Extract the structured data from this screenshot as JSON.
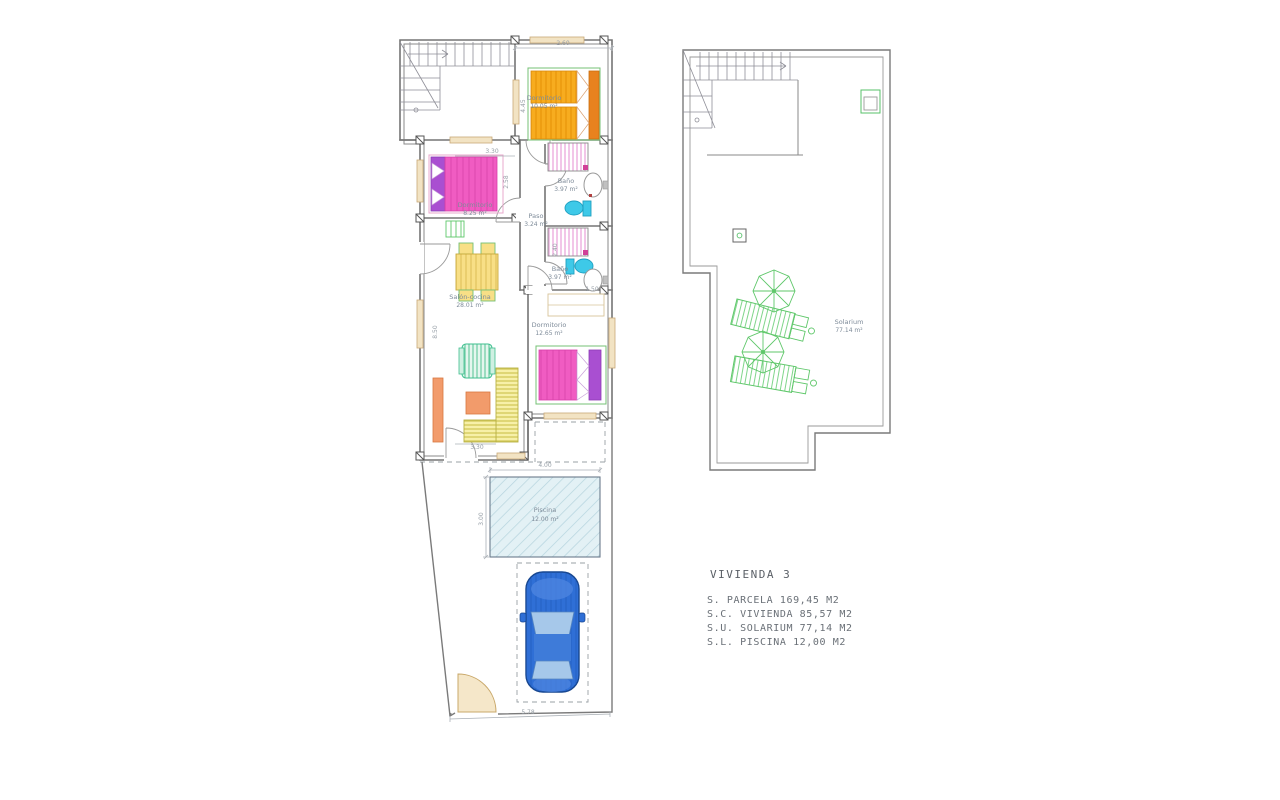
{
  "document": {
    "type": "architectural floor plan",
    "sheet_background": "#ffffff"
  },
  "ground_floor": {
    "rooms": {
      "dormitorio_top": {
        "name": "Dormitorio",
        "area": "10.05 m²"
      },
      "bano_1": {
        "name": "Baño",
        "area": "3.97 m²"
      },
      "dormitorio_mid": {
        "name": "Dormitorio",
        "area": "8.25 m²"
      },
      "paso": {
        "name": "Paso",
        "area": "3.24 m²"
      },
      "bano_2": {
        "name": "Baño",
        "area": "3.97 m²"
      },
      "salon_cocina": {
        "name": "Salón-cocina",
        "area": "28.01 m²"
      },
      "dormitorio_bottom": {
        "name": "Dormitorio",
        "area": "12.65 m²"
      },
      "piscina": {
        "name": "Piscina",
        "area": "12.00 m²"
      }
    },
    "dimensions": {
      "top_width": "2.60",
      "dorm_top_depth": "4.45",
      "dorm_mid_width": "3.30",
      "dorm_mid_depth": "2.58",
      "salon_height": "8.50",
      "bano2_depth": "2.40",
      "bano2_width": "1.50",
      "terrace_door": "3.30",
      "pool_width": "4.00",
      "pool_depth": "3.00",
      "plot_bottom_width": "5.78"
    }
  },
  "roof": {
    "rooms": {
      "solarium": {
        "name": "Solarium",
        "area": "77.14 m²"
      }
    }
  },
  "summary": {
    "title": "VIVIENDA 3",
    "lines": [
      "S. PARCELA 169,45 M2",
      "S.C. VIVIENDA 85,57 M2",
      "S.U. SOLARIUM 77,14 M2",
      "S.L. PISCINA 12,00 M2"
    ]
  },
  "palette": {
    "bed_orange": "#F7AC1F",
    "bed_pink": "#F05CC2",
    "headboard_purple": "#A94FD1",
    "toilet_cyan": "#3EC9E8",
    "pool_fill": "#E3F1F5",
    "car_blue": "#2F6FD6",
    "furniture_green": "#5FC76A",
    "counter_yellow": "#F7F0A8",
    "cabinet_orange": "#F29B6B",
    "window_tan": "#F2E3C3"
  }
}
